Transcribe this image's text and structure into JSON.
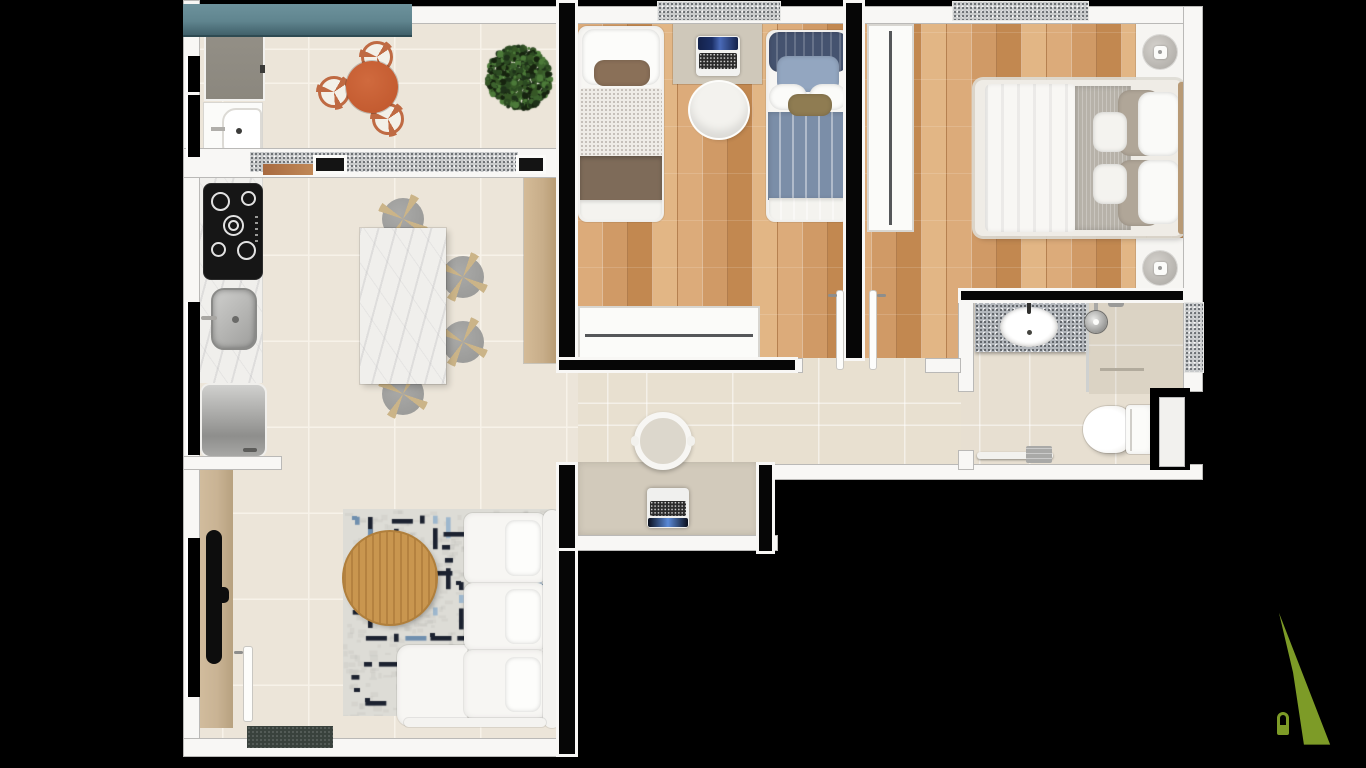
{
  "scene": {
    "type": "apartment floor plan, 3D top-down architectural render",
    "background": "#000000",
    "canvas": {
      "width": 1366,
      "height": 768
    },
    "visible_text": []
  },
  "palette": {
    "bg": "#000000",
    "wall": "#f8f7f5",
    "wall_core": "#060606",
    "tile_floor": "#ece5d9",
    "tile_grout": "#f7f2e9",
    "hall_floor": "#e8e0d0",
    "bath_floor": "#e7dfd1",
    "wood_a": "#dcab7a",
    "wood_b": "#d09a66",
    "wood_c": "#e2b685",
    "wood_d": "#c28850",
    "granite": "#c9cbcc",
    "granite_dark": "#55595e",
    "counter_granite": "#b4b8bd",
    "planter_teal": "#60858f",
    "planter_teal_dark": "#40606a",
    "table_orange": "#c45c31",
    "chair_frame": "#bf6a43",
    "plant_dark": "#243820",
    "marble": "#f0efec",
    "sideboard_wood": "#c7ad89",
    "stool_gray": "#9c9c9a",
    "stool_leg": "#cbb488",
    "appliance_gray": "#8b877e",
    "cooktop_black": "#161616",
    "rug_base": "#dddcd6",
    "rug_dark": "#1c2230",
    "rug_blue": "#6f8fae",
    "rug_blue_light": "#9db7cd",
    "coffee_wood": "#c9964f",
    "sofa_white": "#f7f6f3",
    "tv_black": "#0d0d0d",
    "tv_panel_wood": "#c9b394",
    "doormat": "#39423d",
    "desk_tan": "#d2cabb",
    "duvet_blue": "#7b8ea8",
    "pillow_navy": "#45536f",
    "pillow_blue": "#93a6c0",
    "pillow_olive": "#8f7c52",
    "blanket_brown": "#7e6b59",
    "pillow_brown": "#8a7058",
    "blanket_gray": "#b7b2a9",
    "pillow_taupe": "#b0a698",
    "lamp_gray": "#b5b2ad",
    "headboard_tan": "#b89a76",
    "laptop_navy": "#1b2f66",
    "logo_green": "#7d9b27"
  },
  "rooms": [
    {
      "name": "balcony-laundry",
      "furniture": [
        "planter-box",
        "washing-machine",
        "laundry-sink",
        "round-dining-table",
        "dining-chair",
        "dining-chair",
        "dining-chair",
        "potted-plant"
      ]
    },
    {
      "name": "kitchen-dining",
      "furniture": [
        "cooktop-4-burners",
        "counter-sink",
        "refrigerator",
        "marble-island",
        "bar-stool",
        "bar-stool",
        "bar-stool",
        "bar-stool",
        "wood-sideboard"
      ]
    },
    {
      "name": "bedroom-1",
      "furniture": [
        "single-bed",
        "single-bed",
        "desk",
        "laptop",
        "desk-chair",
        "wardrobe"
      ]
    },
    {
      "name": "bedroom-2",
      "furniture": [
        "double-bed",
        "nightstand",
        "nightstand",
        "table-lamp",
        "table-lamp",
        "wardrobe"
      ]
    },
    {
      "name": "bathroom",
      "furniture": [
        "vanity-counter",
        "sink-basin",
        "shower",
        "glass-divider",
        "toilet",
        "towel-rail",
        "cabinet"
      ]
    },
    {
      "name": "hallway",
      "furniture": [
        "built-in-desk",
        "laptop",
        "chair"
      ]
    },
    {
      "name": "living-room",
      "furniture": [
        "sofa",
        "chaise",
        "coffee-table",
        "patterned-rug",
        "tv",
        "tv-wood-panel",
        "entry-door",
        "doormat"
      ]
    }
  ],
  "branding": {
    "logo_shape": "stylized letter-A / house monogram",
    "logo_color": "#7d9b27"
  }
}
